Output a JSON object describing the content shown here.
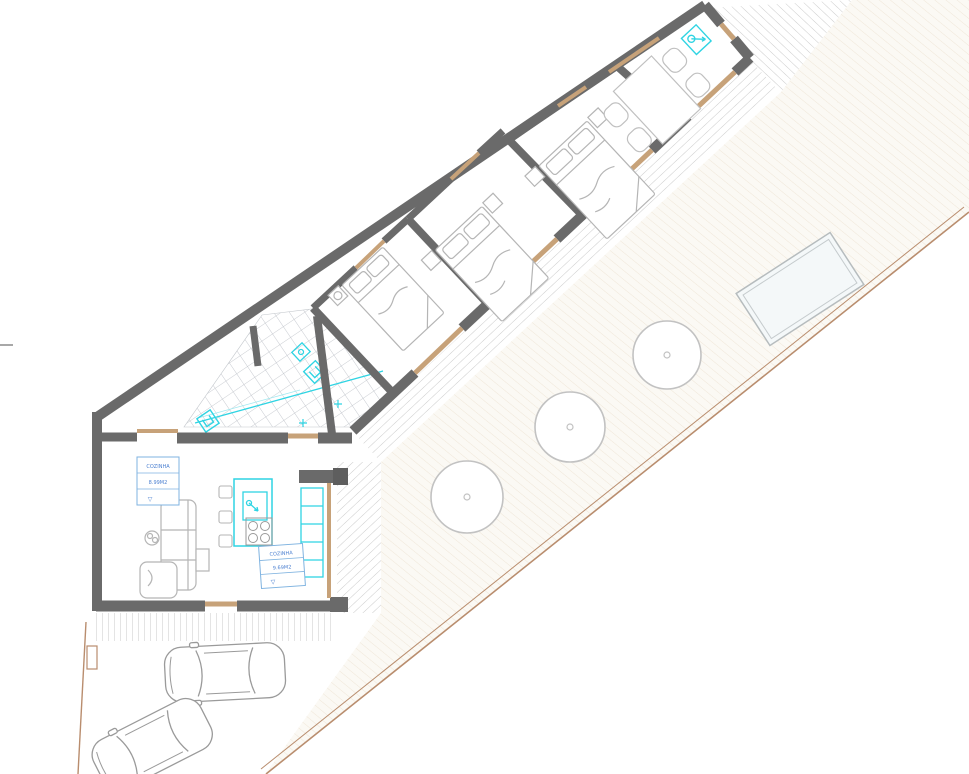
{
  "document": {
    "type": "architectural-site-and-floor-plan",
    "background": "#ffffff"
  },
  "annotations": {
    "label_living": {
      "room": "COZINHA",
      "area": "8.99M2",
      "symbol": "▽"
    },
    "label_kitchen": {
      "room": "COZINHA",
      "area": "9.69M2",
      "symbol": "▽"
    }
  },
  "palette": {
    "wall": "#6a6a6a",
    "wall_edge": "#4f4f4f",
    "wood_tan": "#c7a279",
    "fixture_cyan": "#2fd4e3",
    "label_border_blue": "#7fb3e0",
    "label_text_blue": "#4a7fd0",
    "boundary_tan": "#b98d6e",
    "tile_line": "#b9bdc4",
    "deck_hatch": "#cbcbcb",
    "yard_hatch": "#efe6d8",
    "yard_fill": "#fbf9f4",
    "furniture_line": "#b5b5b5",
    "car_line": "#9a9a9a",
    "pool_line": "#b6bcbe",
    "pool_fill": "#f4f8f9"
  },
  "features": {
    "trees": 3,
    "cars": 2,
    "beds": 3,
    "toilets": 2,
    "dining_chairs": 4,
    "kitchen_stools": 3,
    "pools": 1
  }
}
